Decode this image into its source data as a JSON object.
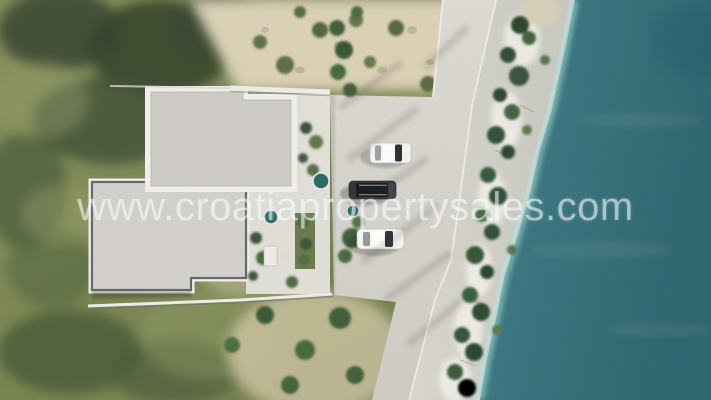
{
  "watermark": {
    "text": "www.croatiapropertysales.com"
  },
  "palette": {
    "sea_deep": "#2b636e",
    "sea_light": "#3f7d87",
    "sea_shallow": "#9ad0cf",
    "rock_band": "#d6d4cb",
    "rock_light": "#efede5",
    "sand": "#ddd2b5",
    "grass_base": "#7e8855",
    "grass_dark_trees": "#37452e",
    "concrete": "#d8d5ce",
    "roof_field": "#cfccc6",
    "roof_parapet": "#efeeea",
    "roof_outline": "#61656b",
    "wall_white": "#eceae4",
    "pool_teal": "#2d6b68",
    "car_white_top": "#f2f2f0",
    "car_dark_middle": "#35383b",
    "car_white_bottom": "#f4f4f2"
  },
  "scene": {
    "type": "aerial-architectural-render",
    "elements": {
      "sea": "teal sea water, right side",
      "shoreline_rocks": "white rocky coastline with green trees",
      "coast_road": "concrete access road and parking driveway",
      "upper_villa_roof": "flat gravel roof with white parapet",
      "lower_villa_roof": "flat gravel roof with dark parapet outline",
      "courtyard": "terrace with plants, round teal umbrellas and furniture",
      "cars": [
        "white car (top)",
        "dark car (middle)",
        "white car (bottom)"
      ],
      "vegetation": "olive green grass and dark trees, left side",
      "sand": "bare sandy ground with bushes, top centre"
    }
  }
}
